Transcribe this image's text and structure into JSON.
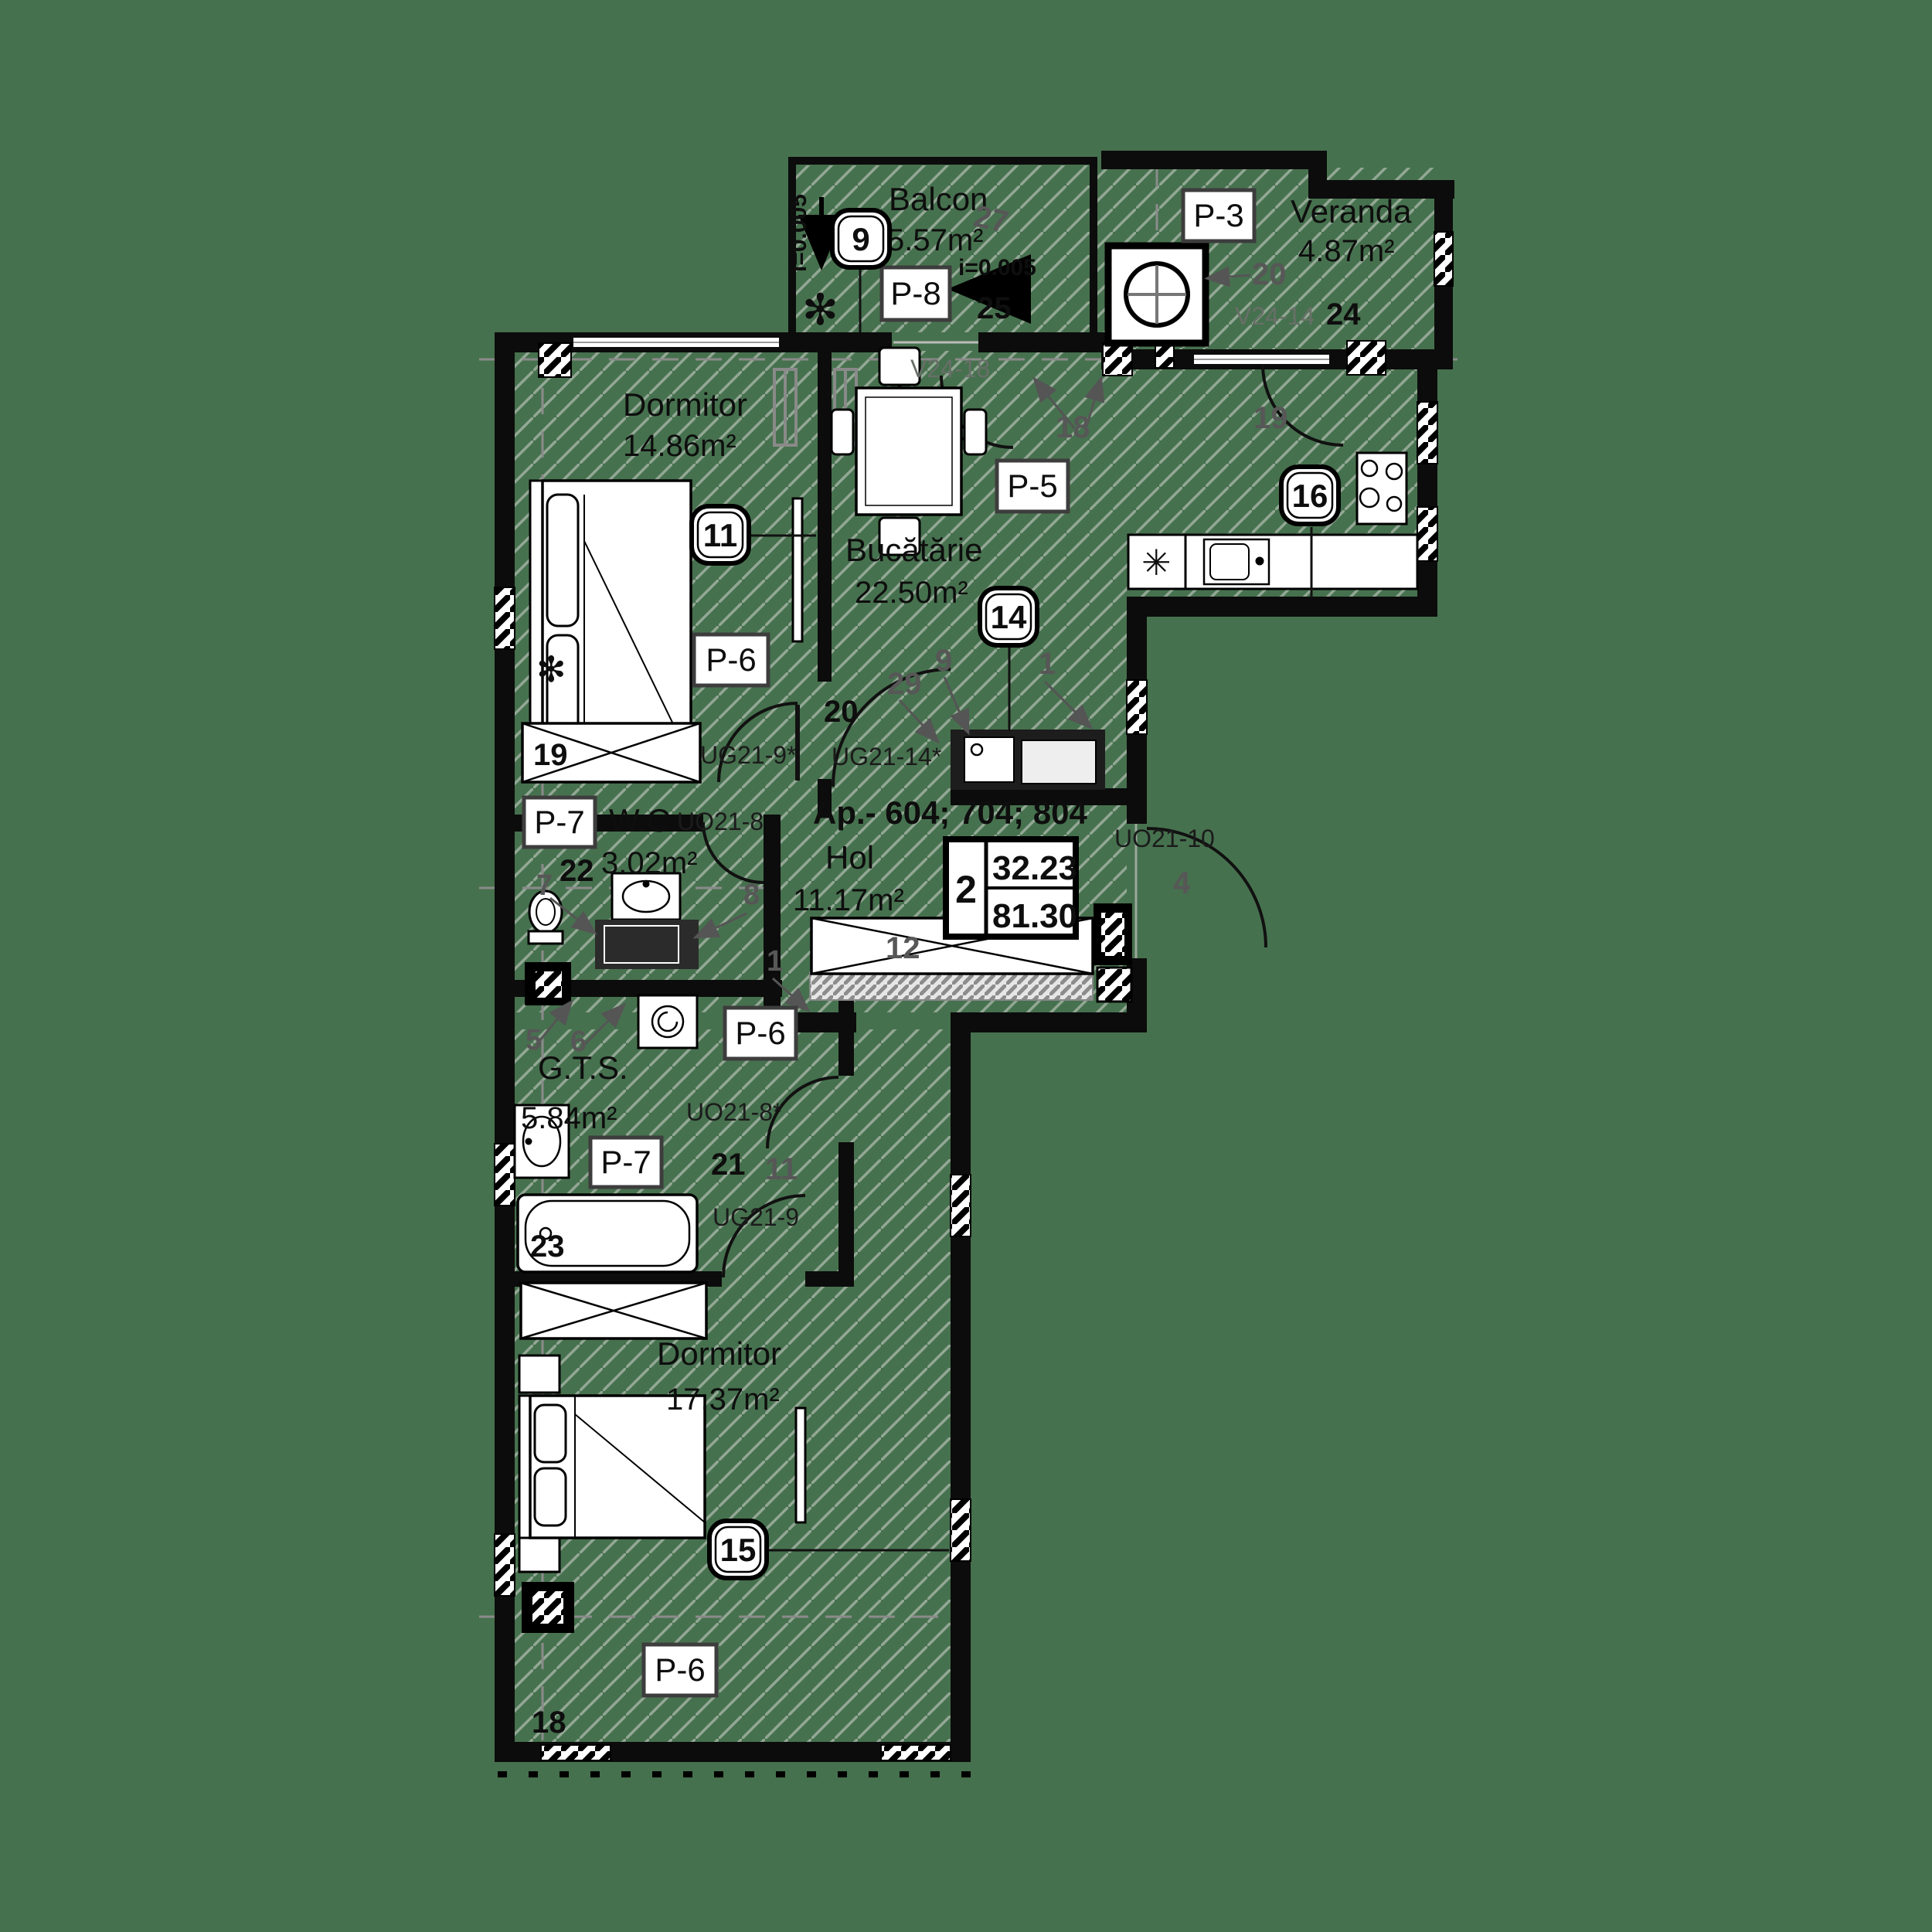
{
  "background": "#46714E",
  "badges": {
    "b9": "9",
    "b11": "11",
    "b14": "14",
    "b15": "15",
    "b16": "16"
  },
  "tags": {
    "p3": "P-3",
    "p5": "P-5",
    "p6": "P-6",
    "p7": "P-7",
    "p8": "P-8"
  },
  "rooms": {
    "balcon": {
      "name": "Balcon",
      "area": "5.57m²",
      "slope": "i=0.005",
      "slope2": "i=0.005",
      "window_code": "V24-18",
      "dims": {
        "d27": "27",
        "d25": "25"
      }
    },
    "veranda": {
      "name": "Veranda",
      "area": "4.87m²",
      "window_code": "V24-14",
      "dims": {
        "d20": "20",
        "d24": "24",
        "d19": "19",
        "d18": "18"
      }
    },
    "dormitor1": {
      "name": "Dormitor",
      "area": "14.86m²",
      "door_code": "UG21-9*",
      "wardrobe": "19"
    },
    "bucatarie": {
      "name": "Bucătărie",
      "area": "22.50m²",
      "door_code": "UG21-14*",
      "dims": {
        "d20": "20",
        "d29": "29",
        "d9": "9",
        "d1": "1"
      }
    },
    "wc": {
      "name": "W.C.",
      "area": "3.02m²",
      "door_code": "UO21-8",
      "dims": {
        "d7": "7",
        "d22": "22",
        "d8": "8",
        "d1": "1"
      }
    },
    "hol": {
      "name": "Hol",
      "area": "11.17m²",
      "apartments": "Ap.- 604; 704; 804",
      "entry_door_code": "UO21-10",
      "wardrobe": "12",
      "dims": {
        "d4": "4"
      }
    },
    "gts": {
      "name": "G.T.S.",
      "area": "5.84m²",
      "door_code": "UO21-8*",
      "door_code2": "UG21-9",
      "bath": "23",
      "dims": {
        "d21": "21",
        "d11": "11",
        "d5": "5",
        "d6": "6"
      }
    },
    "dormitor2": {
      "name": "Dormitor",
      "area": "17.37m²",
      "dims": {
        "d18": "18"
      }
    }
  },
  "area_table": {
    "rooms": "2",
    "living": "32.23",
    "total": "81.30"
  },
  "icons": {
    "plant": "✻",
    "fridge": "✳"
  }
}
